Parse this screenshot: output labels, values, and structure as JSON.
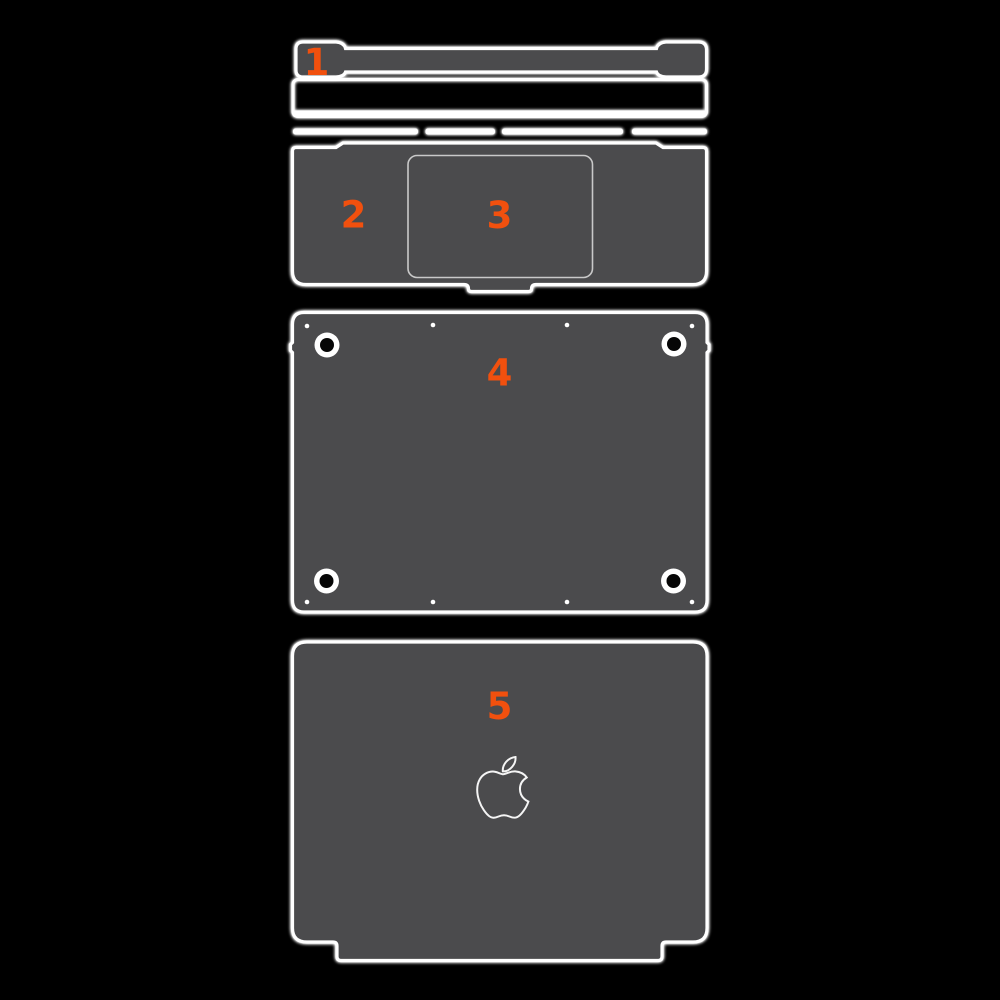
{
  "diagram": {
    "background_color": "#000000",
    "piece_fill_color": "#4b4b4d",
    "outline_color": "#ffffff",
    "accent_color": "#f1500e",
    "labels": [
      {
        "piece": "hinge-cover",
        "text": "1"
      },
      {
        "piece": "keyboard-surround",
        "text": "2"
      },
      {
        "piece": "trackpad",
        "text": "3"
      },
      {
        "piece": "bottom-cover",
        "text": "4"
      },
      {
        "piece": "top-lid",
        "text": "5"
      }
    ],
    "icons": [
      {
        "name": "apple-logo-icon",
        "style": "outline"
      }
    ]
  }
}
